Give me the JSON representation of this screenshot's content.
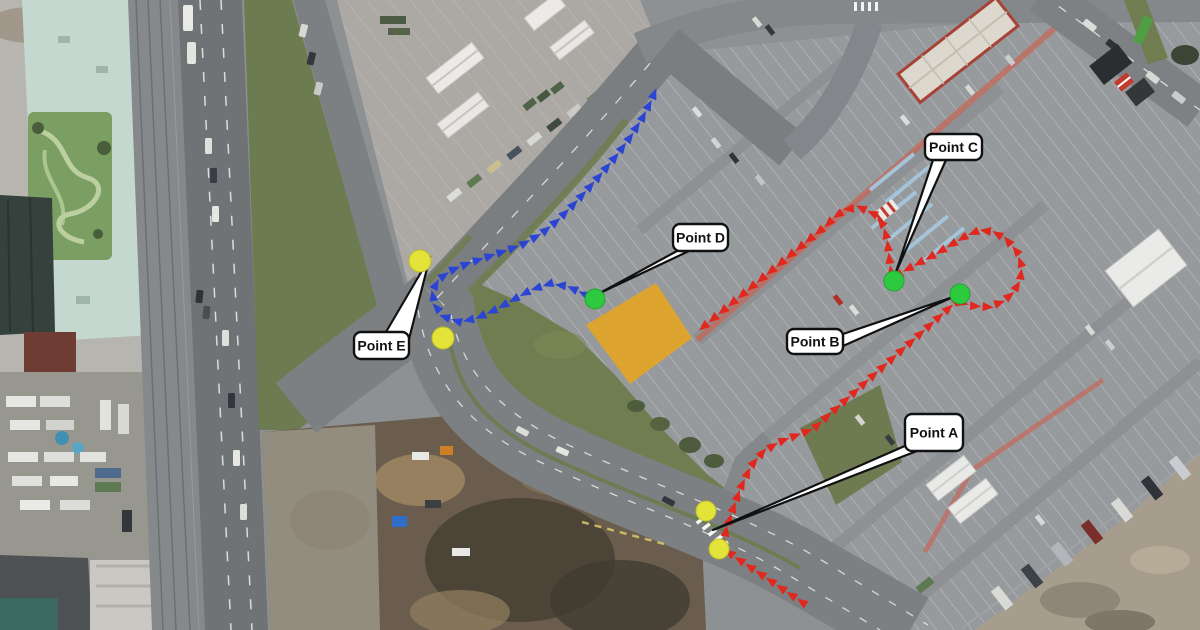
{
  "map": {
    "type": "annotated-aerial-route-map",
    "labels": [
      {
        "id": "a",
        "text": "Point A",
        "box": [
          905,
          414,
          58,
          37
        ],
        "leader_tip": [
          713,
          530
        ],
        "leader_base": [
          [
            907,
            445
          ],
          [
            917,
            451
          ]
        ]
      },
      {
        "id": "b",
        "text": "Point B",
        "box": [
          787,
          329,
          56,
          25
        ],
        "leader_tip": [
          953,
          297
        ],
        "leader_base": [
          [
            843,
            334
          ],
          [
            843,
            346
          ]
        ]
      },
      {
        "id": "c",
        "text": "Point C",
        "box": [
          925,
          134,
          57,
          26
        ],
        "leader_tip": [
          896,
          272
        ],
        "leader_base": [
          [
            933,
            160
          ],
          [
            946,
            160
          ]
        ]
      },
      {
        "id": "d",
        "text": "Point D",
        "box": [
          673,
          224,
          55,
          27
        ],
        "leader_tip": [
          600,
          293
        ],
        "leader_base": [
          [
            677,
            251
          ],
          [
            689,
            251
          ]
        ]
      },
      {
        "id": "e",
        "text": "Point E",
        "box": [
          354,
          332,
          55,
          27
        ],
        "leader_tip": [
          430,
          257
        ],
        "leader_base": [
          [
            386,
            332
          ],
          [
            409,
            339
          ]
        ]
      }
    ],
    "label_style": {
      "bg": "#ffffff",
      "border": "#111111",
      "text_color": "#111111"
    },
    "markers": {
      "yellow": {
        "color": "#e3e33a",
        "stroke": "#bdbf2c",
        "points": [
          [
            420,
            261,
            11
          ],
          [
            443,
            338,
            11
          ],
          [
            706,
            511,
            10
          ],
          [
            719,
            549,
            10
          ]
        ]
      },
      "green": {
        "color": "#2dc93f",
        "stroke": "#23a331",
        "points": [
          [
            595,
            299,
            10
          ],
          [
            894,
            281,
            10
          ],
          [
            960,
            294,
            10
          ]
        ]
      }
    },
    "zone": {
      "name": "orange-staging-zone",
      "color": "#e8a51c",
      "opacity": 0.85,
      "polygon": [
        [
          656,
          283
        ],
        [
          692,
          338
        ],
        [
          630,
          384
        ],
        [
          586,
          325
        ]
      ]
    },
    "routes": [
      {
        "name": "red-route-entry-a-to-b",
        "color": "#e0281e",
        "spacing": 12.5,
        "size": 11,
        "points": [
          [
            802,
            602
          ],
          [
            768,
            579
          ],
          [
            738,
            559
          ],
          [
            723,
            548
          ],
          [
            726,
            531
          ],
          [
            733,
            509
          ],
          [
            741,
            487
          ],
          [
            751,
            466
          ],
          [
            763,
            452
          ],
          [
            779,
            442
          ],
          [
            797,
            435
          ],
          [
            813,
            429
          ],
          [
            885,
            365
          ],
          [
            958,
            300
          ]
        ]
      },
      {
        "name": "red-route-b-loop-to-c",
        "color": "#e0281e",
        "spacing": 12.5,
        "size": 11,
        "points": [
          [
            963,
            303
          ],
          [
            974,
            306
          ],
          [
            988,
            307
          ],
          [
            1002,
            302
          ],
          [
            1013,
            293
          ],
          [
            1020,
            281
          ],
          [
            1022,
            267
          ],
          [
            1017,
            252
          ],
          [
            1007,
            240
          ],
          [
            994,
            232
          ],
          [
            980,
            230
          ],
          [
            966,
            236
          ],
          [
            951,
            245
          ],
          [
            936,
            254
          ],
          [
            921,
            262
          ],
          [
            906,
            270
          ],
          [
            897,
            276
          ]
        ]
      },
      {
        "name": "red-route-c-to-staging",
        "color": "#e0281e",
        "spacing": 12.5,
        "size": 11,
        "points": [
          [
            891,
            271
          ],
          [
            889,
            255
          ],
          [
            887,
            239
          ],
          [
            883,
            225
          ],
          [
            874,
            214
          ],
          [
            861,
            208
          ],
          [
            847,
            209
          ],
          [
            836,
            216
          ],
          [
            827,
            225
          ],
          [
            810,
            239
          ],
          [
            793,
            253
          ],
          [
            776,
            267
          ],
          [
            759,
            281
          ],
          [
            742,
            295
          ],
          [
            725,
            309
          ],
          [
            708,
            323
          ],
          [
            696,
            333
          ]
        ]
      },
      {
        "name": "blue-route-exit-d-via-e",
        "color": "#2b44d4",
        "spacing": 12.5,
        "size": 11,
        "points": [
          [
            584,
            294
          ],
          [
            567,
            286
          ],
          [
            549,
            284
          ],
          [
            531,
            290
          ],
          [
            513,
            300
          ],
          [
            495,
            310
          ],
          [
            477,
            318
          ],
          [
            460,
            322
          ],
          [
            445,
            317
          ],
          [
            435,
            306
          ],
          [
            432,
            292
          ],
          [
            439,
            279
          ],
          [
            452,
            270
          ],
          [
            469,
            263
          ],
          [
            487,
            257
          ],
          [
            505,
            251
          ],
          [
            523,
            244
          ],
          [
            541,
            234
          ],
          [
            557,
            221
          ],
          [
            572,
            206
          ],
          [
            587,
            190
          ],
          [
            602,
            173
          ],
          [
            617,
            155
          ],
          [
            631,
            136
          ],
          [
            643,
            117
          ],
          [
            652,
            99
          ],
          [
            658,
            84
          ]
        ]
      }
    ]
  }
}
